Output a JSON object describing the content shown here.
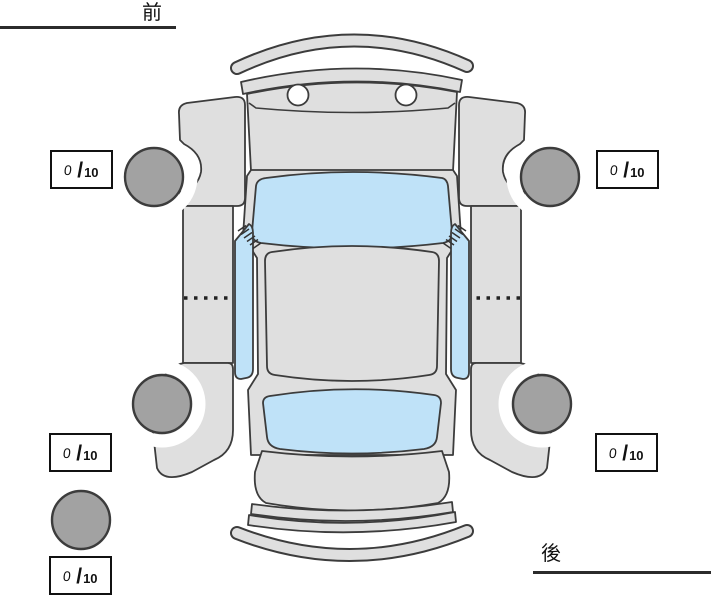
{
  "labels": {
    "front": "前",
    "rear": "後"
  },
  "scores": {
    "front_left": {
      "value": "0",
      "slash": "/",
      "max": "10"
    },
    "front_right": {
      "value": "0",
      "slash": "/",
      "max": "10"
    },
    "rear_left": {
      "value": "0",
      "slash": "/",
      "max": "10"
    },
    "rear_right": {
      "value": "0",
      "slash": "/",
      "max": "10"
    },
    "spare": {
      "value": "0",
      "slash": "/",
      "max": "10"
    }
  },
  "colors": {
    "background": "#ffffff",
    "body_fill": "#dfdfdf",
    "glass_fill": "#bfe2f8",
    "tire_fill": "#a2a2a2",
    "outline": "#3c3c3c",
    "box_border": "#111111",
    "text": "#111111"
  },
  "icons": {
    "tire": "tire-circle",
    "spare_tire": "spare-tire-circle",
    "car": "car-top-view-exploded"
  }
}
